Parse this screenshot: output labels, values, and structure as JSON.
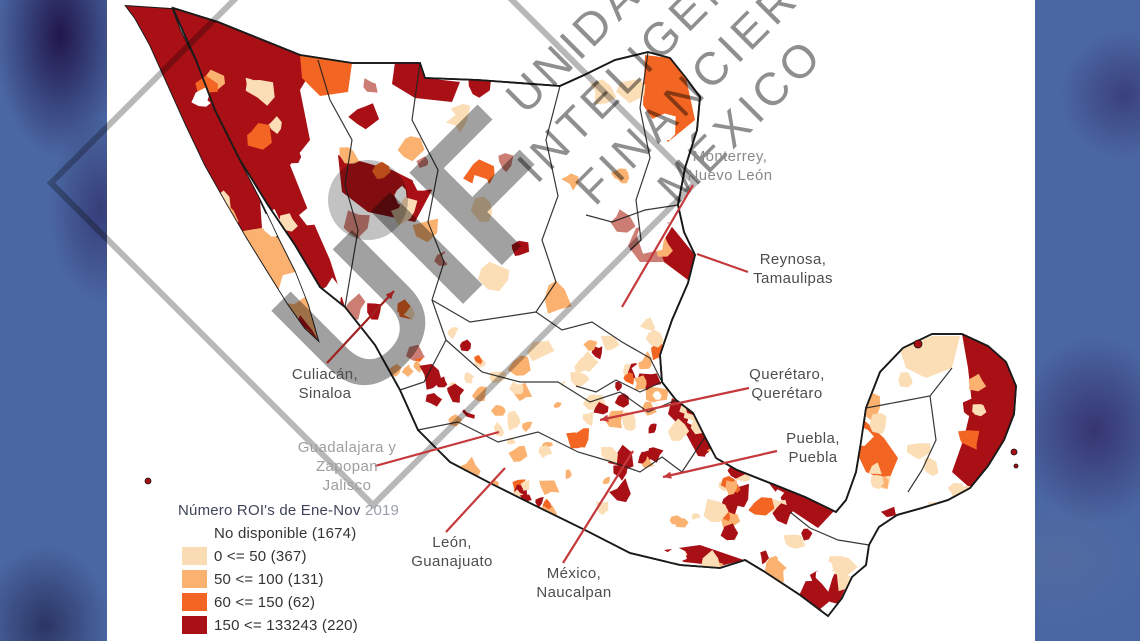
{
  "background": {
    "blue": "#4a67a3"
  },
  "panel": {
    "bg": "#ffffff"
  },
  "watermark": {
    "lines": [
      "UNIDAD DE",
      "INTELIGENCIA",
      "FINANCIERA",
      "MÉXICO"
    ],
    "big_text": "UIF",
    "text_color": "#8f8f8f",
    "frame_color": "#9a9a9a",
    "diamond_points": "373,-139 695,183 373,505 51,183",
    "dot": {
      "cx": 368,
      "cy": 200,
      "r": 40
    }
  },
  "legend": {
    "title": "Número ROI's de Ene-Nov",
    "title_year": "2019",
    "items": [
      {
        "label": "No disponible (1674)",
        "color": ""
      },
      {
        "label": "0 <= 50 (367)",
        "color": "#FADCB4"
      },
      {
        "label": "50 <= 100 (131)",
        "color": "#FBB271"
      },
      {
        "label": "60 <= 150 (62)",
        "color": "#F26522"
      },
      {
        "label": "150 <= 133243 (220)",
        "color": "#A81016"
      }
    ]
  },
  "annotations": [
    {
      "id": "monterrey",
      "text": "Monterrey,\nNuevo León",
      "x": 730,
      "y": 148,
      "color": "#8a8a8a",
      "line": {
        "x1": 693,
        "y1": 185,
        "x2": 622,
        "y2": 307
      },
      "line_color": "#c5393c",
      "arrow": false
    },
    {
      "id": "reynosa",
      "text": "Reynosa,\nTamaulipas",
      "x": 793,
      "y": 251,
      "color": "#4d4d4d",
      "line": {
        "x1": 748,
        "y1": 272,
        "x2": 697,
        "y2": 254
      },
      "line_color": "#c5393c",
      "arrow": false
    },
    {
      "id": "culiacan",
      "text": "Culiacán,\nSinaloa",
      "x": 325,
      "y": 366,
      "color": "#4d4d4d",
      "line": {
        "x1": 327,
        "y1": 363,
        "x2": 394,
        "y2": 291
      },
      "line_color": "#9e2321",
      "arrow": true
    },
    {
      "id": "guadalajara",
      "text": "Guadalajara y\nZapopan\nJalisco",
      "x": 347,
      "y": 439,
      "color": "#9e9e9e",
      "line": {
        "x1": 375,
        "y1": 466,
        "x2": 499,
        "y2": 432
      },
      "line_color": "#c5393c",
      "arrow": false
    },
    {
      "id": "leon",
      "text": "León,\nGuanajuato",
      "x": 452,
      "y": 534,
      "color": "#4d4d4d",
      "line": {
        "x1": 446,
        "y1": 532,
        "x2": 505,
        "y2": 468
      },
      "line_color": "#c5393c",
      "arrow": false
    },
    {
      "id": "mexico",
      "text": "México,\nNaucalpan",
      "x": 574,
      "y": 565,
      "color": "#4d4d4d",
      "line": {
        "x1": 563,
        "y1": 563,
        "x2": 633,
        "y2": 451
      },
      "line_color": "#c5393c",
      "arrow": false
    },
    {
      "id": "queretaro",
      "text": "Querétaro,\nQuerétaro",
      "x": 787,
      "y": 366,
      "color": "#4d4d4d",
      "line": {
        "x1": 749,
        "y1": 388,
        "x2": 600,
        "y2": 420
      },
      "line_color": "#c5393c",
      "arrow": true
    },
    {
      "id": "puebla",
      "text": "Puebla,\nPuebla",
      "x": 813,
      "y": 430,
      "color": "#4d4d4d",
      "line": {
        "x1": 777,
        "y1": 451,
        "x2": 663,
        "y2": 477
      },
      "line_color": "#c5393c",
      "arrow": true
    }
  ],
  "map": {
    "palette": {
      "wh": "#ffffff",
      "pe": "#FBDDB6",
      "lo": "#FBB271",
      "or": "#F26522",
      "dr": "#A91016",
      "ro": "#CC7E74"
    },
    "outline_color": "#1a1a1a",
    "mainland": "M173,8 L218,22 L300,55 L352,63 L420,63 L425,78 L478,80 L560,86 L582,76 L615,60 L648,52 L670,58 L686,78 L700,97 L697,130 L685,168 L678,205 L684,232 L695,255 L688,283 L672,320 L660,355 L662,382 L676,400 L693,413 L705,437 L716,458 L737,470 L770,483 L805,497 L836,512 L846,500 L856,472 L861,442 L866,408 L880,372 L903,348 L932,334 L962,334 L988,346 L1006,362 L1016,386 L1014,414 L1004,440 L988,466 L970,488 L948,500 L922,508 L897,515 L879,527 L869,545 L866,565 L852,577 L842,598 L828,616 L800,595 L765,572 L745,560 L720,568 L680,565 L630,553 L585,530 L540,508 L490,483 L450,462 L418,430 L400,390 L375,345 L345,307 L320,287 L295,245 L268,205 L240,160 L215,110 L196,60 L178,20 Z",
    "baja": "M126,6 L172,9 L180,30 L196,62 L214,110 L238,158 L260,200 L278,238 L295,272 L308,305 L318,340 L305,328 L288,304 L268,272 L247,238 L226,202 L205,165 L186,125 L168,85 L150,45 L135,18 Z",
    "major_patches": [
      {
        "c": "dr",
        "pts": "126,6 172,9 180,30 196,62 214,110 238,158 260,200 262,228 238,232 226,202 205,165 186,125 168,85 150,45 135,18"
      },
      {
        "c": "lo",
        "pts": "262,228 278,238 295,272 308,305 318,340 305,328 288,304 268,272 247,238 238,232"
      },
      {
        "c": "dr",
        "pts": "300,315 312,330 318,340 308,330 298,322"
      },
      {
        "c": "dr",
        "pts": "173,8 240,28 300,50 318,60 300,90 310,140 290,165 308,210 330,260 345,307 320,287 295,245 268,205 240,160 215,110 196,60 178,20"
      },
      {
        "c": "or",
        "pts": "300,55 352,63 348,92 320,96 302,78"
      },
      {
        "c": "dr",
        "pts": "395,62 420,63 425,78 460,82 452,102 415,98 392,84"
      },
      {
        "c": "dr",
        "pts": "338,155 392,170 432,190 415,222 368,212 342,192"
      },
      {
        "c": "or",
        "pts": "645,55 670,58 686,78 695,120 668,142 643,105"
      },
      {
        "c": "dr",
        "pts": "668,222 695,255 688,280 664,262 656,240"
      },
      {
        "c": "ro",
        "pts": "636,228 668,222 656,240 664,262 640,262 628,246"
      },
      {
        "c": "dr",
        "pts": "672,398 693,413 705,437 716,458 698,456 684,430 668,414"
      },
      {
        "c": "dr",
        "pts": "962,334 988,346 1006,362 1016,386 1014,414 1004,440 988,466 970,488 952,472 964,438 972,404 968,368"
      },
      {
        "c": "or",
        "pts": "858,455 864,420 884,438 898,458 888,482 866,472"
      },
      {
        "c": "pe",
        "pts": "900,350 932,336 960,336 952,368 926,378 906,368"
      },
      {
        "c": "dr",
        "pts": "798,598 826,614 840,600 850,578 832,562 808,576"
      },
      {
        "c": "dr",
        "pts": "768,482 804,496 834,511 818,528 788,508"
      },
      {
        "c": "dr",
        "pts": "700,545 738,558 744,560 720,566 684,562 664,550"
      },
      {
        "c": "ro",
        "pts": "320,287 345,307 375,345 398,385 388,392 362,352 335,315 312,295"
      },
      {
        "c": "dr",
        "pts": "352,320 375,345 388,370 376,378 358,348"
      },
      {
        "c": "lo",
        "pts": "398,385 400,390 418,430 440,458 428,462 408,435 392,398"
      }
    ],
    "borders": [
      "318,60 330,100 352,140 345,185 358,230 345,307",
      "420,63 412,120 438,170 428,222 444,262 432,300 446,340 424,382 400,390",
      "560,86 546,140 558,196 542,240 556,282 536,312",
      "648,52 640,108 650,158 636,200 641,240 630,250",
      "536,312 562,330 592,322 622,342 650,358 662,382",
      "432,300 470,322 510,316 536,312",
      "446,340 482,372 520,382 558,382 590,402 620,392 648,412 676,400",
      "418,430 458,422 498,442 538,432 578,452 612,462 640,472 662,457 682,472 705,437",
      "869,545 838,540 810,528 790,512",
      "866,408 898,402 930,396 952,368",
      "930,396 936,440 922,470 908,492",
      "678,205 645,210 612,222 586,215",
      "662,382 640,392 616,380 596,392 576,386"
    ],
    "islands": [
      {
        "cx": 148,
        "cy": 481,
        "r": 3,
        "c": "dr"
      },
      {
        "cx": 918,
        "cy": 344,
        "r": 4,
        "c": "dr"
      },
      {
        "cx": 1014,
        "cy": 452,
        "r": 3,
        "c": "dr"
      },
      {
        "cx": 1016,
        "cy": 466,
        "r": 2,
        "c": "dr"
      }
    ],
    "regions": [
      {
        "x": [
          195,
          670
        ],
        "y": [
          70,
          300
        ],
        "count": 60,
        "rmin": 6,
        "rmax": 16,
        "weights": {
          "wh": 34,
          "pe": 20,
          "lo": 12,
          "or": 8,
          "dr": 14,
          "ro": 12
        }
      },
      {
        "x": [
          330,
          470
        ],
        "y": [
          300,
          460
        ],
        "count": 32,
        "rmin": 5,
        "rmax": 12,
        "weights": {
          "pe": 28,
          "lo": 20,
          "or": 10,
          "dr": 20,
          "ro": 14,
          "wh": 8
        }
      },
      {
        "x": [
          440,
          740
        ],
        "y": [
          340,
          525
        ],
        "count": 115,
        "rmin": 4,
        "rmax": 11,
        "weights": {
          "wh": 24,
          "pe": 26,
          "lo": 16,
          "or": 13,
          "dr": 21
        }
      },
      {
        "x": [
          600,
          860
        ],
        "y": [
          455,
          610
        ],
        "count": 50,
        "rmin": 5,
        "rmax": 13,
        "weights": {
          "wh": 28,
          "pe": 26,
          "lo": 12,
          "or": 9,
          "dr": 25
        }
      },
      {
        "x": [
          855,
          1015
        ],
        "y": [
          335,
          520
        ],
        "count": 30,
        "rmin": 6,
        "rmax": 13,
        "weights": {
          "wh": 34,
          "pe": 30,
          "lo": 16,
          "or": 6,
          "dr": 14
        }
      },
      {
        "x": [
          640,
          720
        ],
        "y": [
          290,
          430
        ],
        "count": 20,
        "rmin": 4,
        "rmax": 10,
        "weights": {
          "wh": 30,
          "pe": 25,
          "lo": 15,
          "or": 10,
          "dr": 20
        }
      }
    ]
  }
}
